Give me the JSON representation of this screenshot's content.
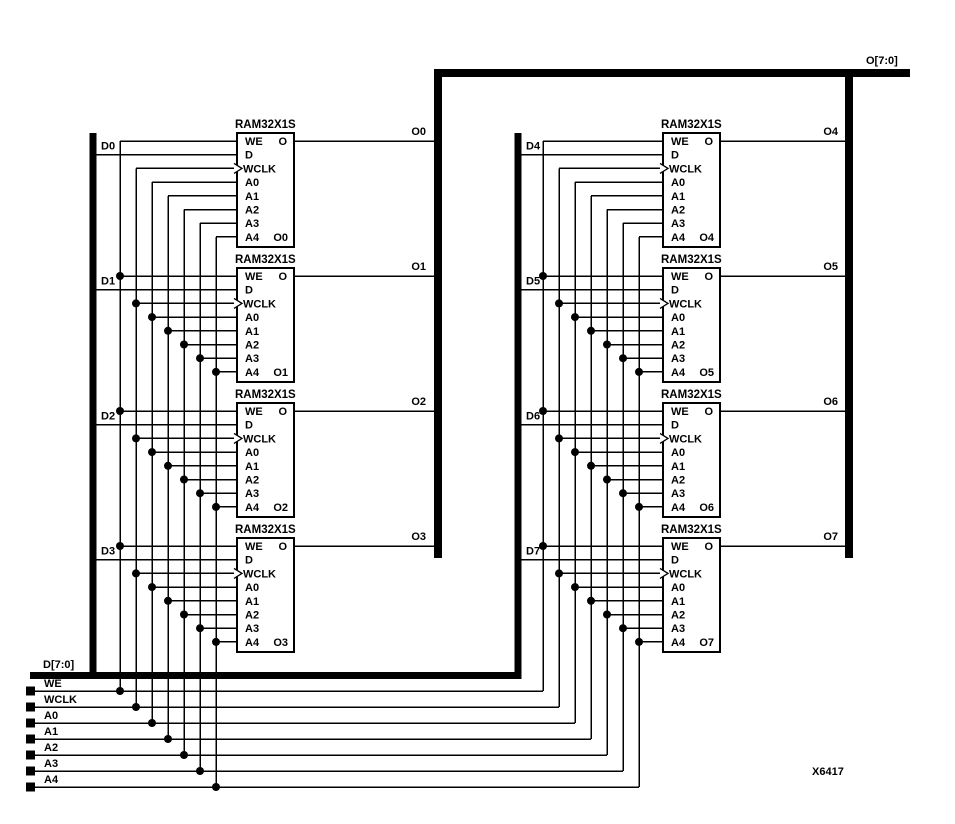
{
  "colors": {
    "ink": "#000000",
    "paper": "#ffffff"
  },
  "block_title": "RAM32X1S",
  "pins": [
    "WE",
    "D",
    "WCLK",
    "A0",
    "A1",
    "A2",
    "A3",
    "A4"
  ],
  "output_pin": "O",
  "blocks": [
    {
      "d": "D0",
      "o": "O0"
    },
    {
      "d": "D1",
      "o": "O1"
    },
    {
      "d": "D2",
      "o": "O2"
    },
    {
      "d": "D3",
      "o": "O3"
    },
    {
      "d": "D4",
      "o": "O4"
    },
    {
      "d": "D5",
      "o": "O5"
    },
    {
      "d": "D6",
      "o": "O6"
    },
    {
      "d": "D7",
      "o": "O7"
    }
  ],
  "output_bus_label": "O[7:0]",
  "input_bus_label": "D[7:0]",
  "control_signals": [
    "WE",
    "WCLK",
    "A0",
    "A1",
    "A2",
    "A3",
    "A4"
  ],
  "figure_ref": "X6417"
}
